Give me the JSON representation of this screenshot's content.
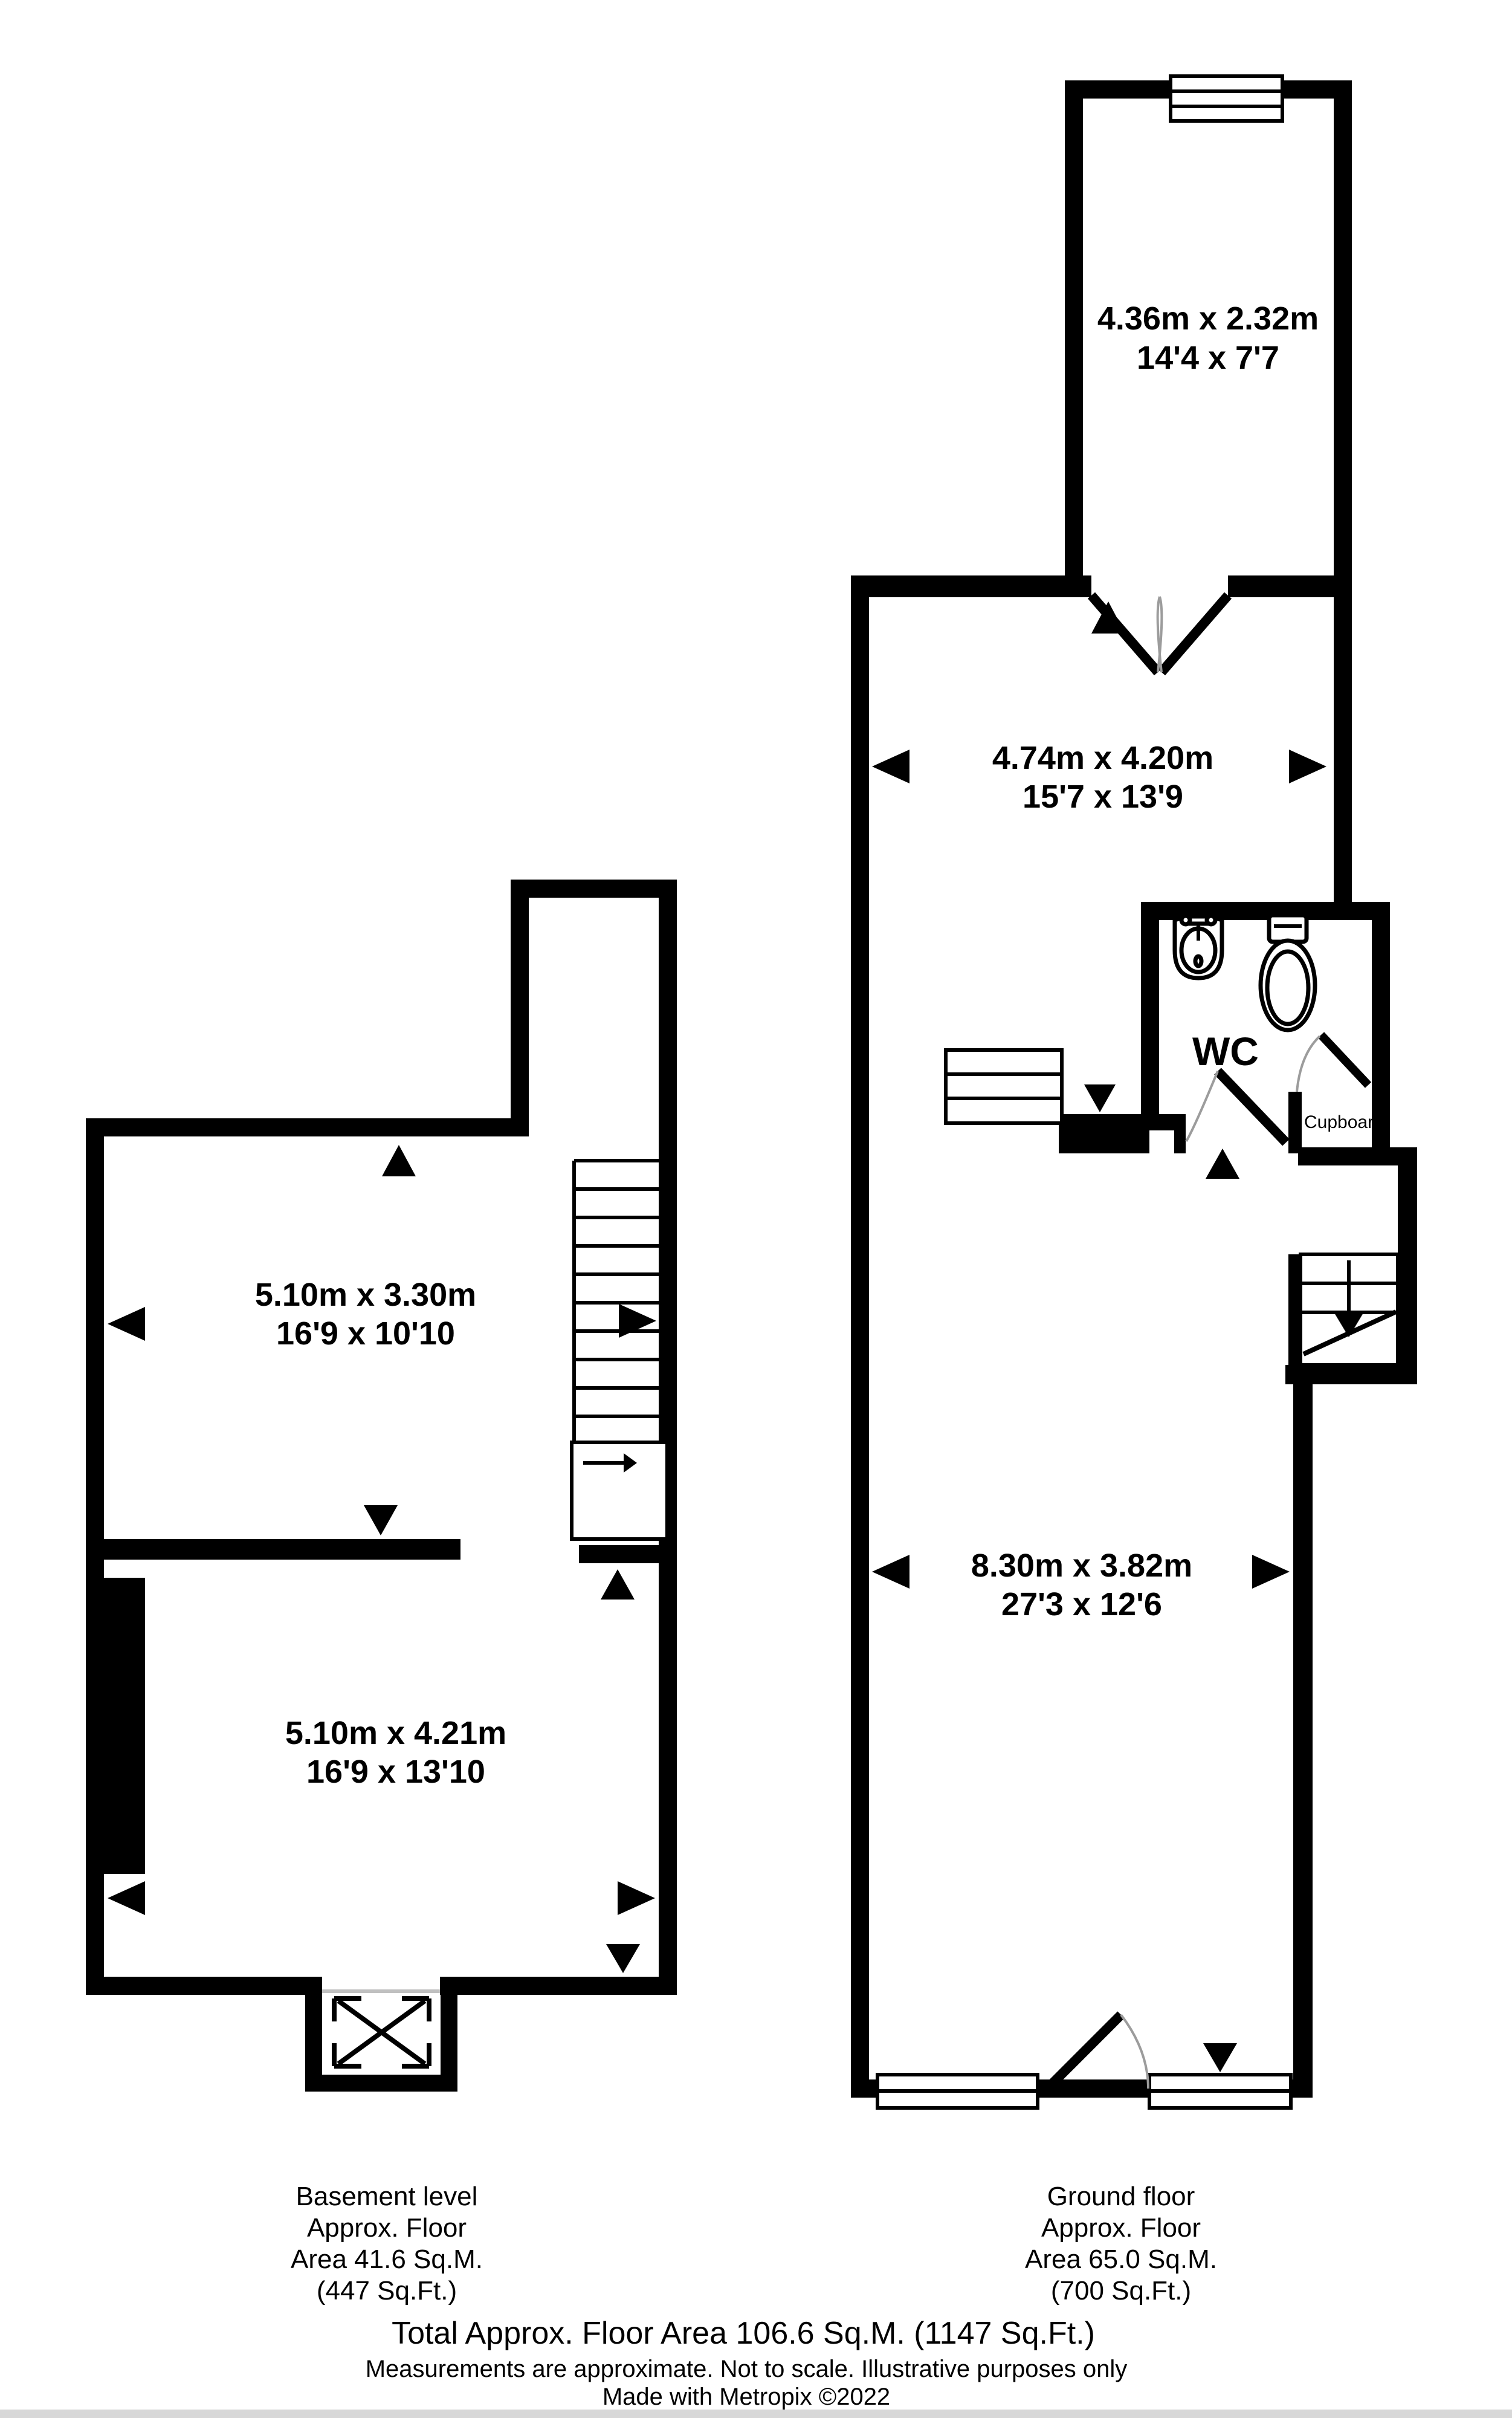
{
  "basement": {
    "rooms": [
      {
        "dims_m": "5.10m x 3.30m",
        "dims_ft": "16'9 x 10'10"
      },
      {
        "dims_m": "5.10m x 4.21m",
        "dims_ft": "16'9 x 13'10"
      }
    ],
    "caption": [
      "Basement level",
      "Approx. Floor",
      "Area 41.6 Sq.M.",
      "(447 Sq.Ft.)"
    ]
  },
  "ground": {
    "rooms": [
      {
        "dims_m": "4.36m x 2.32m",
        "dims_ft": "14'4 x 7'7"
      },
      {
        "dims_m": "4.74m x 4.20m",
        "dims_ft": "15'7 x 13'9"
      },
      {
        "dims_m": "8.30m x 3.82m",
        "dims_ft": "27'3 x 12'6"
      }
    ],
    "wc_label": "WC",
    "cupboard_label": "Cupboard",
    "caption": [
      "Ground floor",
      "Approx. Floor",
      "Area 65.0 Sq.M.",
      "(700 Sq.Ft.)"
    ]
  },
  "footer": {
    "total": "Total Approx. Floor Area 106.6 Sq.M. (1147 Sq.Ft.)",
    "disclaimer": "Measurements are approximate.  Not to scale.  Illustrative purposes only",
    "credit": "Made with Metropix ©2022"
  },
  "colors": {
    "wall": "#000000",
    "door_arc": "#9c9c9c",
    "footer_bar": "#d8d8d8",
    "background": "#ffffff"
  }
}
